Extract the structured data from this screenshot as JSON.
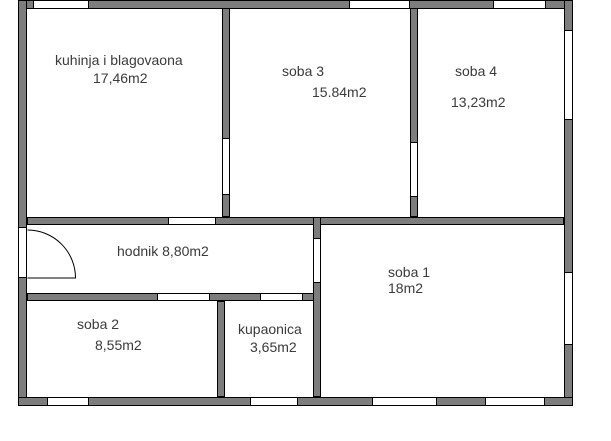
{
  "plan": {
    "type": "apartment-floor-plan",
    "colors": {
      "wall_fill": "#7d7d7d",
      "wall_outline": "#000000",
      "floor": "#ffffff",
      "text": "#3b3b3b"
    },
    "rooms": {
      "kitchen": {
        "name": "kuhinja i blagovaona",
        "area": "17,46m2"
      },
      "soba3": {
        "name": "soba 3",
        "area": "15.84m2"
      },
      "soba4": {
        "name": "soba 4",
        "area": "13,23m2"
      },
      "hodnik": {
        "label": "hodnik 8,80m2"
      },
      "soba1": {
        "name": "soba 1",
        "area": "18m2"
      },
      "soba2": {
        "name": "soba 2",
        "area": "8,55m2"
      },
      "kupaonica": {
        "name": "kupaonica",
        "area": "3,65m2"
      }
    }
  }
}
